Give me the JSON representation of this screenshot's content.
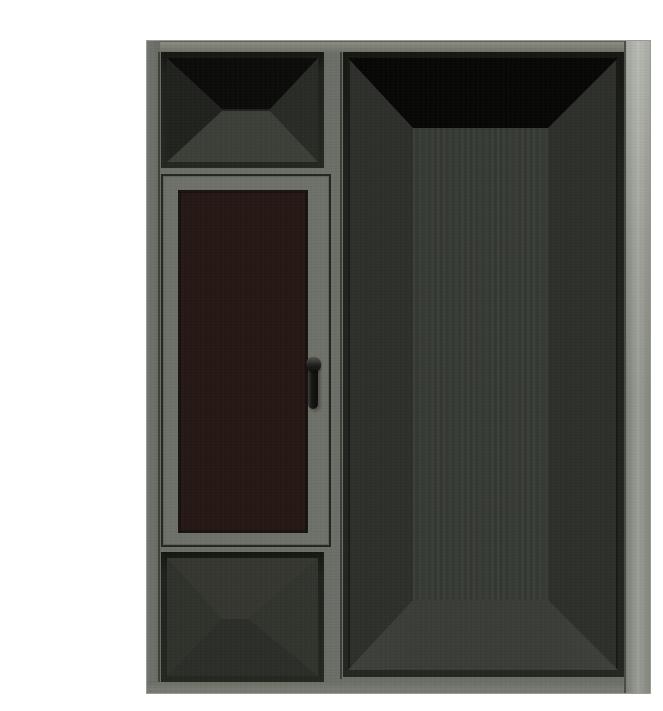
{
  "scene": {
    "description": "3D product render of a grey aluminium window and door frame combination on a white background",
    "background": "#ffffff",
    "parts": {
      "left_column": {
        "transom": "top transom opening shown empty in perspective",
        "casement": "casement window with dark tinted glazing and black lever handle",
        "handle": "black lever window handle",
        "bottom_panel": "lower panel opening shown empty in perspective"
      },
      "right_panel": "full-height door opening shown empty in perspective"
    }
  },
  "colors": {
    "background": "#ffffff",
    "frame_base": "#6b6e66",
    "frame_top_light": "#8a8d82",
    "frame_right_light": "#9b9e96",
    "frame_left": "#71746c",
    "frame_bottom": "#787b71",
    "bevel_dark": "#1e201b",
    "sash_face": "#6e7168",
    "glass_tint": "#241713",
    "glass_edge": "#171210",
    "handle_black": "#0d0d0c",
    "handle_highlight": "#55554f",
    "interior_wall": "#2d2f2a",
    "interior_back_wall": "#363a34",
    "interior_floor": "#3a3d37",
    "interior_ceiling_black": "#060605",
    "transom_ceiling": "#0a0a08",
    "transom_floor": "#3c3f38",
    "transom_wall_left": "#1f211c",
    "transom_wall_right": "#282a24",
    "panel_top_shade": "#34362f",
    "panel_bottom_shade": "#2b2d27",
    "panel_wall_left": "#2f312b",
    "panel_wall_right": "#31332d"
  }
}
